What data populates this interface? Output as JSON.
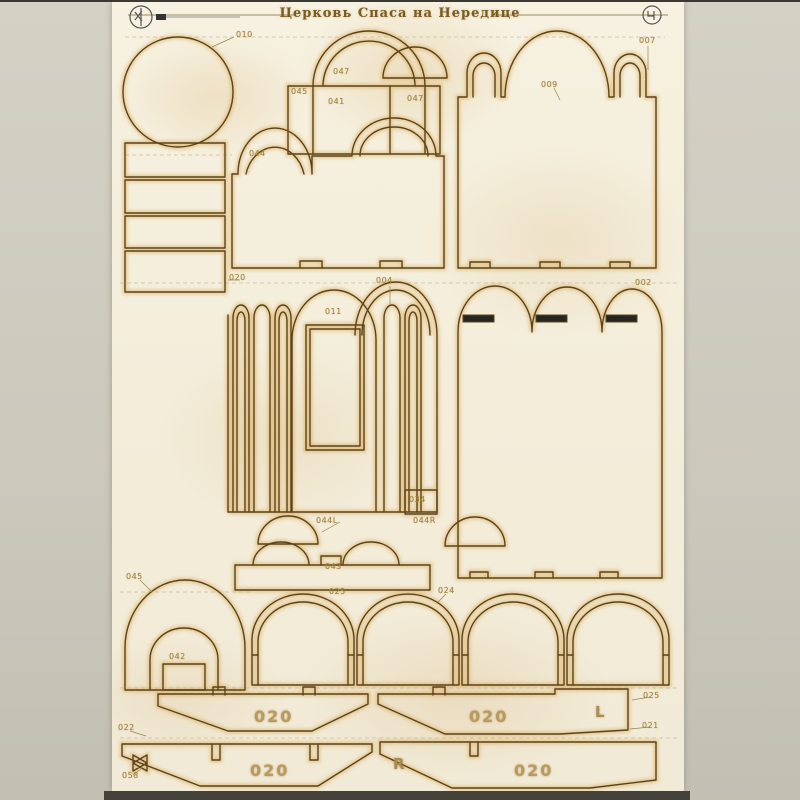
{
  "header": {
    "title": "Церковь Спаса на Нередице"
  },
  "colors": {
    "paper": "#f5efdc",
    "cut_line": "#5a431a",
    "burn_glow": "#d8a752",
    "slot_fill": "#26251f",
    "label_ink": "#a3853e"
  },
  "part_labels": [
    {
      "text": "010"
    },
    {
      "text": "047"
    },
    {
      "text": "045"
    },
    {
      "text": "041"
    },
    {
      "text": "047"
    },
    {
      "text": "009"
    },
    {
      "text": "007"
    },
    {
      "text": "044"
    },
    {
      "text": "020"
    },
    {
      "text": "004"
    },
    {
      "text": "011"
    },
    {
      "text": "002"
    },
    {
      "text": "034"
    },
    {
      "text": "044L"
    },
    {
      "text": "044R"
    },
    {
      "text": "043"
    },
    {
      "text": "025"
    },
    {
      "text": "045"
    },
    {
      "text": "024"
    },
    {
      "text": "042"
    },
    {
      "text": "025"
    },
    {
      "text": "021"
    },
    {
      "text": "022"
    },
    {
      "text": "058"
    }
  ],
  "engravings": {
    "plate_number": "020",
    "left_mark": "L",
    "right_mark": "R"
  }
}
